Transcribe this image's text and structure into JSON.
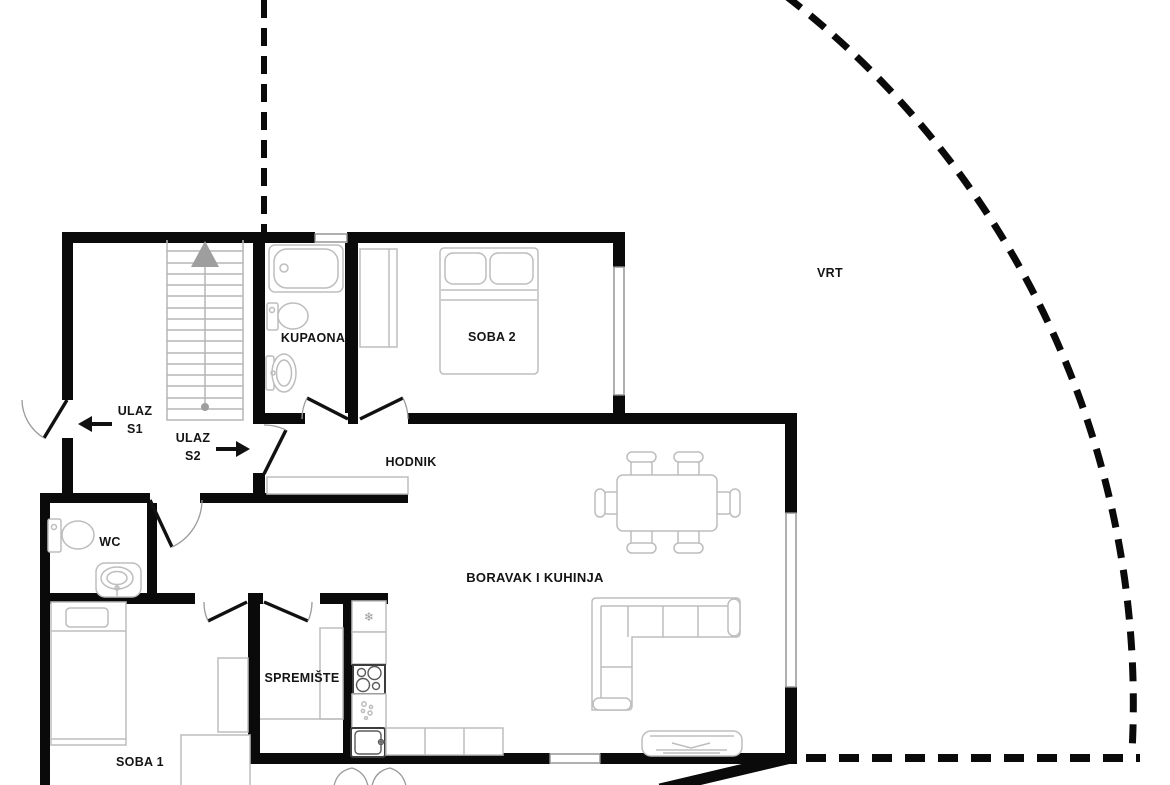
{
  "plan": {
    "type": "apartment-floor-plan",
    "labels": {
      "ulaz_s1_line1": "ULAZ",
      "ulaz_s1_line2": "S1",
      "ulaz_s2_line1": "ULAZ",
      "ulaz_s2_line2": "S2",
      "kupaona": "KUPAONA",
      "soba2": "SOBA 2",
      "hodnik": "HODNIK",
      "wc": "WC",
      "boravak": "BORAVAK I KUHINJA",
      "spremiste": "SPREMIŠTE",
      "soba1": "SOBA 1",
      "vrt": "VRT"
    },
    "icons": {
      "fridge": "❄"
    },
    "colors": {
      "wall": "#0a0a0a",
      "furniture_outline": "#bdbdbd",
      "fixture_dark": "#3c3c3c",
      "stairs": "#b5b5b5",
      "stairs_accent": "#9e9e9e",
      "window_border": "#8f8f8f",
      "door_leaf": "#111111",
      "door_arc": "#9b9b9b",
      "text": "#141414",
      "background": "#ffffff"
    }
  }
}
